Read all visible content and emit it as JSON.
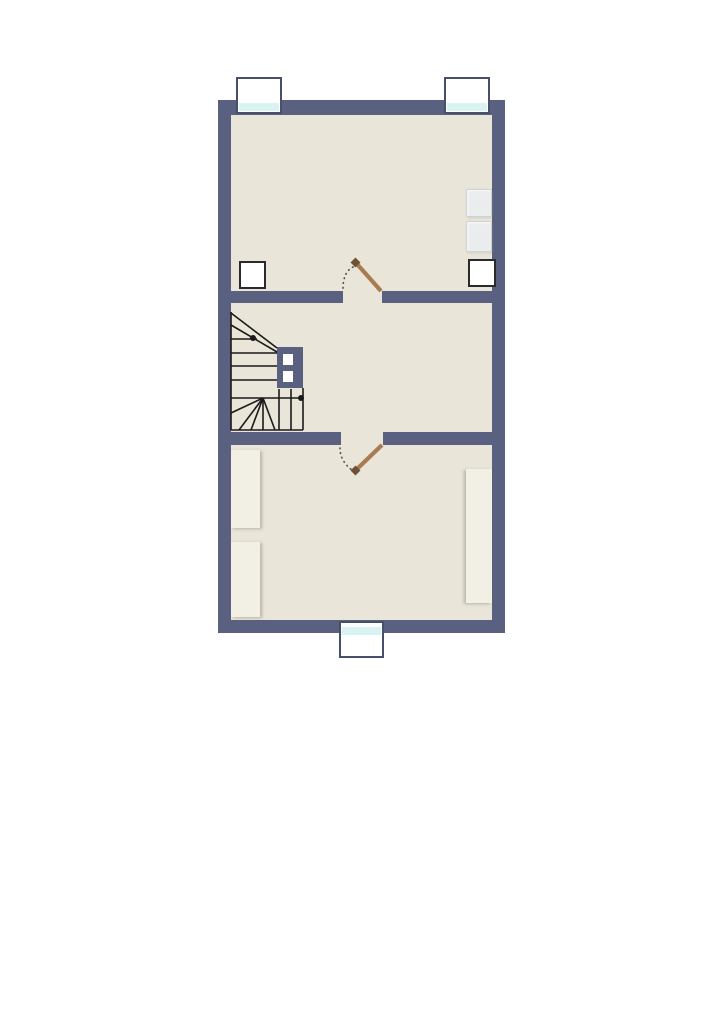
{
  "title": "upper-floor-plan",
  "colors": {
    "background": "#ffffff",
    "wall": "#5a6180",
    "floor": "#e9e5d9",
    "stair_line": "#1a1a1a",
    "door_leaf": "#a87c50",
    "door_cap": "#6f5233",
    "swing_dots": "#4a4a4a",
    "window_glass": "#d9f2f2",
    "window_frame": "#ffffff",
    "window_border": "#47506b",
    "furniture_light": "#f2efe5",
    "furniture_gray": "#eaecee",
    "furniture_gray_border": "#d0d3d6",
    "white_box_fill": "#ffffff",
    "white_box_border": "#2a2a2a"
  },
  "plan": {
    "canvas": {
      "w": 724,
      "h": 1024
    },
    "outer_wall": {
      "name": "exterior-wall",
      "x": 218,
      "y": 100,
      "w": 287,
      "h": 533
    },
    "floor": {
      "name": "interior-floor",
      "x": 231,
      "y": 115,
      "w": 261,
      "h": 505
    },
    "rooms": [
      {
        "name": "room-upper",
        "x": 231,
        "y": 115,
        "w": 261,
        "h": 176
      },
      {
        "name": "room-middle-landing",
        "x": 231,
        "y": 303,
        "w": 261,
        "h": 129
      },
      {
        "name": "room-lower",
        "x": 231,
        "y": 445,
        "w": 261,
        "h": 175
      }
    ],
    "interior_walls": [
      {
        "name": "partition-upper-left",
        "x": 231,
        "y": 291,
        "w": 112,
        "h": 12
      },
      {
        "name": "partition-upper-right",
        "x": 382,
        "y": 291,
        "w": 110,
        "h": 12
      },
      {
        "name": "partition-lower-left",
        "x": 231,
        "y": 432,
        "w": 110,
        "h": 13
      },
      {
        "name": "partition-lower-right",
        "x": 383,
        "y": 432,
        "w": 109,
        "h": 13
      }
    ],
    "chimney": {
      "name": "chimney-shaft",
      "x": 277,
      "y": 347,
      "w": 26,
      "h": 41,
      "vents": [
        {
          "x": 283,
          "y": 354,
          "w": 10,
          "h": 11
        },
        {
          "x": 283,
          "y": 371,
          "w": 10,
          "h": 11
        }
      ]
    },
    "windows": [
      {
        "name": "window-top-left",
        "x": 236,
        "y": 77,
        "w": 46,
        "h": 37,
        "glass": {
          "y_rel": 23,
          "h": 10
        }
      },
      {
        "name": "window-top-right",
        "x": 444,
        "y": 77,
        "w": 46,
        "h": 37,
        "glass": {
          "y_rel": 23,
          "h": 10
        }
      },
      {
        "name": "window-bottom",
        "x": 339,
        "y": 621,
        "w": 45,
        "h": 37,
        "glass": {
          "y_rel": 3,
          "h": 10
        }
      }
    ],
    "furniture": [
      {
        "name": "cabinet-upper-right-1",
        "kind": "gray",
        "x": 466,
        "y": 189,
        "w": 26,
        "h": 28
      },
      {
        "name": "cabinet-upper-right-2",
        "kind": "gray",
        "x": 466,
        "y": 221,
        "w": 26,
        "h": 31
      },
      {
        "name": "box-upper-left",
        "kind": "whitebox",
        "x": 239,
        "y": 261,
        "w": 27,
        "h": 28
      },
      {
        "name": "box-upper-right",
        "kind": "whitebox",
        "x": 468,
        "y": 259,
        "w": 28,
        "h": 28
      },
      {
        "name": "wardrobe-lower-left-1",
        "kind": "light",
        "x": 231,
        "y": 450,
        "w": 29,
        "h": 78,
        "shadow": "right"
      },
      {
        "name": "wardrobe-lower-left-2",
        "kind": "light",
        "x": 231,
        "y": 542,
        "w": 29,
        "h": 75,
        "shadow": "right"
      },
      {
        "name": "wardrobe-lower-right",
        "kind": "light",
        "x": 466,
        "y": 469,
        "w": 26,
        "h": 134,
        "shadow": "left"
      }
    ],
    "stairs": {
      "name": "winder-staircase",
      "lines": [
        [
          231,
          312,
          231,
          430
        ],
        [
          231,
          430,
          303,
          430
        ],
        [
          303,
          388,
          303,
          430
        ],
        [
          231,
          313,
          277,
          348
        ],
        [
          231,
          325,
          277,
          352
        ],
        [
          231,
          339,
          257,
          339
        ],
        [
          231,
          353,
          277,
          353
        ],
        [
          231,
          366,
          277,
          366
        ],
        [
          231,
          380,
          277,
          380
        ],
        [
          231,
          398,
          303,
          398
        ],
        [
          263,
          398,
          231,
          413
        ],
        [
          263,
          398,
          239,
          430
        ],
        [
          263,
          398,
          251,
          430
        ],
        [
          263,
          398,
          263,
          430
        ],
        [
          263,
          398,
          275,
          430
        ],
        [
          279,
          389,
          279,
          430
        ],
        [
          291,
          389,
          291,
          430
        ]
      ],
      "dots": [
        [
          253,
          338
        ],
        [
          301,
          398
        ]
      ]
    },
    "doors": [
      {
        "name": "door-upper-room",
        "hinge": [
          381,
          291
        ],
        "tip": [
          357,
          264
        ],
        "cap": [
          358,
          265,
          353,
          260
        ],
        "swing_path": "M 353,267 Q 343,272 343,289"
      },
      {
        "name": "door-lower-room",
        "hinge": [
          382,
          445
        ],
        "tip": [
          357,
          469
        ],
        "cap": [
          358,
          468,
          353,
          473
        ],
        "swing_path": "M 340,448 Q 340,461 352,470"
      }
    ]
  }
}
